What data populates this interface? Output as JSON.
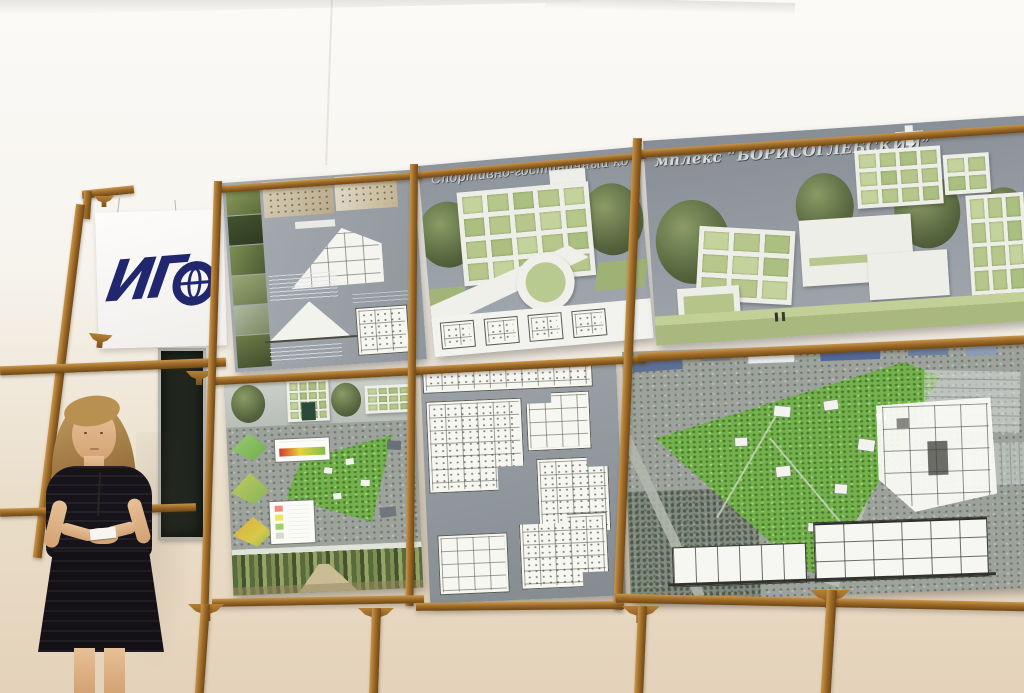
{
  "scene": {
    "boards_title": {
      "full": "Спортивно-гостиничный комплекс “БОРИСОГЛЕБСКИЙ”",
      "left_segment": "Спортивно-гостиничный ко",
      "right_segment": "мплекс “БОРИСОГЛЕБСКИЙ”"
    },
    "logo": {
      "text": "ИГ"
    },
    "colors": {
      "logo_blue": "#20276e",
      "wood_frame": "#9c6a26",
      "board_sky_gray": "#939aa1",
      "facade_green": "#b7c78c",
      "park_green": "#74b14c",
      "wall_white": "#f9f7f3",
      "wall_cream": "#e7d7c0",
      "chalkboard_green": "#20251e",
      "dress_black": "#16131a",
      "legend_gradient": [
        "#d23b2f",
        "#e8d23c",
        "#7fbf45"
      ],
      "legend_swatches": [
        "#ef8c7f",
        "#f2e35e",
        "#9ed065",
        "#d8d8d0"
      ]
    }
  }
}
